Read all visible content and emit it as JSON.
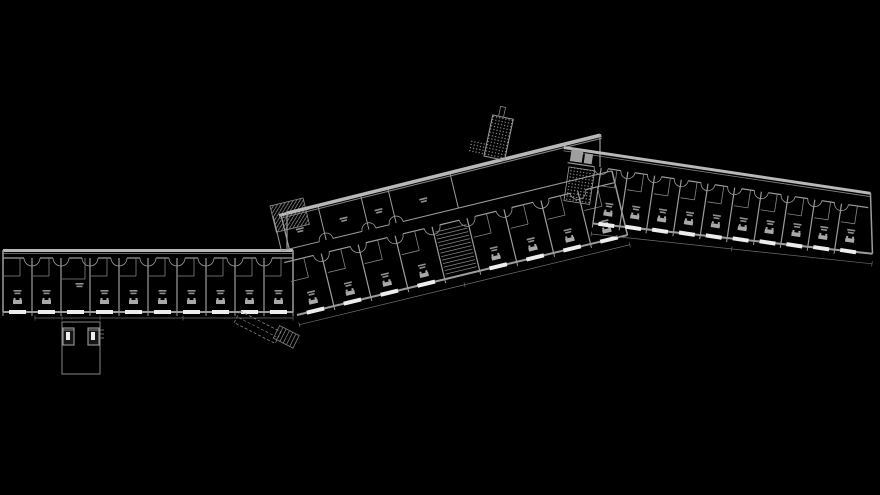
{
  "canvas": {
    "width": 880,
    "height": 495,
    "background": "#000000"
  },
  "palette": {
    "thick_wall": "#b8b8b8",
    "wall": "#9c9c9c",
    "thin": "#858585",
    "dim_line": "#6e6e6e",
    "window": "#ededed",
    "hatch": "#9a9a9a",
    "blob": "#a9a9a9",
    "label_mark": "#8f8f8f",
    "core_fill": "#9f9f9f",
    "lift_void": "#151515"
  },
  "plan": {
    "left_wing": {
      "id": "left-wing",
      "x": 3,
      "y": 249,
      "angle": 0,
      "length": 290,
      "bays": 10,
      "bay_width": 29,
      "rooms_top": 9,
      "rooms_bottom": 63,
      "window_width": 17,
      "door_radius": 8,
      "divided_bay": 2,
      "dim": {
        "y": 69,
        "x1": 32,
        "x2": 290,
        "ticks": [
          32,
          59,
          97,
          180,
          290
        ]
      }
    },
    "tower": {
      "x": 62,
      "y": 322,
      "width": 38,
      "height": 52,
      "lift_w": 11,
      "lift_h": 17,
      "lifts": [
        [
          1,
          6
        ],
        [
          26,
          6
        ]
      ],
      "side_ticks": 3
    },
    "canopy": {
      "x": 240,
      "y": 311,
      "angle": 27,
      "dash_w": 46,
      "dash_h": 13,
      "step_x": 42,
      "step_y": -5,
      "step_w": 22,
      "step_h": 14,
      "steps": 6
    },
    "junction_stair": {
      "x": 270,
      "y": 206,
      "angle": -13.6,
      "w": 34,
      "h": 27
    },
    "outer_wall_mid": {
      "x1": 287,
      "y1": 213,
      "x2": 600,
      "y2": 135
    },
    "apex_connector": {
      "x1": 600,
      "y1": 135,
      "x2": 600,
      "y2": 167
    },
    "entrance": {
      "x": 484,
      "y": 156,
      "angle": 12,
      "w": 21,
      "h": 42,
      "stub_x": 6,
      "stub_w": 5,
      "stub_h": 10,
      "side_w": 16,
      "side_h": 13
    },
    "middle_wing": {
      "id": "middle-wing",
      "x": 297,
      "y": 315,
      "angle": -13.6,
      "bays": [
        38,
        38,
        38,
        38,
        36,
        38,
        38,
        38,
        38
      ],
      "stair_bay": 4,
      "rooms_top": -54,
      "rooms_bottom": 0,
      "corridor_top": -66,
      "window_width": 18,
      "door_radius": 8,
      "upper": {
        "front": -66,
        "door_radius": 7,
        "xs": [
          0,
          46,
          90,
          118,
          182
        ],
        "wall": {
          "x1": 6,
          "y1": -101,
          "x2": 338,
          "y2": -103
        },
        "end_x": 8,
        "label_y": -84
      },
      "dim": {
        "x1": 0,
        "y1": 10,
        "x2": 340,
        "y2": 10
      }
    },
    "right_wing": {
      "id": "right-wing",
      "x": 564,
      "y": 146,
      "angle": 8.5,
      "length": 310,
      "end_bottom_x": 321,
      "rooms_top": 16,
      "bottom_y0": 74,
      "bottom_y1": 61,
      "first_room_x": 40,
      "bay_width": 27,
      "bays": 10,
      "window_width": 16,
      "door_radius": 7,
      "core": {
        "hatch": [
          8,
          20,
          26,
          34
        ],
        "fills": [
          [
            8,
            2,
            12,
            12
          ],
          [
            22,
            4,
            8,
            10
          ]
        ]
      },
      "dim": {
        "x1": 40,
        "y1": 83,
        "x2": 322,
        "y2": 71
      }
    }
  }
}
